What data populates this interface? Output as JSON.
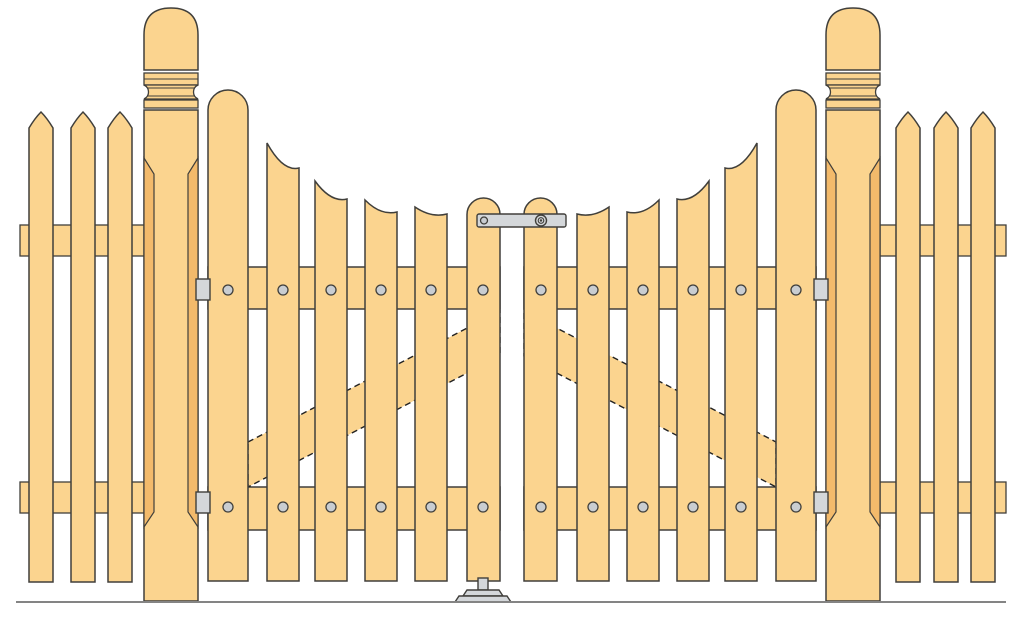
{
  "illustration": {
    "title": "Wooden double picket gate with turned posts and picket fence",
    "colors": {
      "wood": "#FBD48F",
      "wood_shade": "#F3BA6B",
      "outline": "#403F3B",
      "hardware": "#D4D7DA",
      "screw": "#C9CDD1",
      "ground": "#848484",
      "dash": "#222222"
    },
    "canvas": {
      "width": 1024,
      "height": 620
    },
    "ground_line": {
      "x1": 16,
      "y1": 602,
      "x2": 1006,
      "y2": 602
    },
    "fence": {
      "picket_width": 24,
      "picket_apex_y": 112,
      "picket_shoulder_y": 128,
      "picket_bottom_y": 582,
      "rail_upper_y": 225,
      "rail_lower_y": 482,
      "rail_height": 31,
      "left": {
        "rail_x1": 20,
        "rail_x2": 150,
        "pickets_x": [
          29,
          71,
          108
        ]
      },
      "right": {
        "rail_x1": 874,
        "rail_x2": 1006,
        "pickets_x": [
          896,
          934,
          971
        ]
      }
    },
    "posts": {
      "width": 54,
      "left_x": 144,
      "right_x": 826,
      "dome_top_y": 8,
      "dome_bottom_y": 70,
      "band1": [
        73,
        85
      ],
      "neck": [
        85,
        99
      ],
      "band2": [
        100,
        108
      ],
      "shaft": [
        110,
        601
      ],
      "chamfer": [
        158,
        527
      ],
      "chamfer_inset": 10
    },
    "gates": {
      "board_bottom_y": 581,
      "picket_width": 32,
      "rail_upper": {
        "y": 267,
        "h": 42
      },
      "rail_lower": {
        "y": 487,
        "h": 43
      },
      "screw_radius": 5,
      "screw_rows_y": [
        290,
        507
      ],
      "left": {
        "hanging_stile": {
          "x": 208,
          "w": 40,
          "cap_apex_y": 90
        },
        "center_stile": {
          "x": 467,
          "w": 33,
          "cap_apex_y": 198
        },
        "rail_x1": 208,
        "rail_x2": 500,
        "pickets": [
          {
            "x": 267,
            "y_outer": 143,
            "y_inner": 168
          },
          {
            "x": 315,
            "y_outer": 181,
            "y_inner": 199
          },
          {
            "x": 365,
            "y_outer": 200,
            "y_inner": 212
          },
          {
            "x": 415,
            "y_outer": 207,
            "y_inner": 214
          }
        ],
        "screws_x": [
          228,
          283,
          331,
          381,
          431,
          483
        ],
        "brace_points": "248,442 500,311 500,356 248,487"
      },
      "right": {
        "hanging_stile": {
          "x": 776,
          "w": 40,
          "cap_apex_y": 90
        },
        "center_stile": {
          "x": 524,
          "w": 33,
          "cap_apex_y": 198
        },
        "rail_x1": 524,
        "rail_x2": 816,
        "pickets": [
          {
            "x": 577,
            "y_outer": 207,
            "y_inner": 214,
            "mirror": true
          },
          {
            "x": 627,
            "y_outer": 200,
            "y_inner": 212,
            "mirror": true
          },
          {
            "x": 677,
            "y_outer": 181,
            "y_inner": 199,
            "mirror": true
          },
          {
            "x": 725,
            "y_outer": 143,
            "y_inner": 168,
            "mirror": true
          }
        ],
        "screws_x": [
          541,
          593,
          643,
          693,
          741,
          796
        ],
        "brace_points": "524,311 776,442 776,487 524,356"
      }
    },
    "hardware": {
      "hinges": [
        {
          "x": 196,
          "y": 279,
          "w": 14,
          "h": 21
        },
        {
          "x": 196,
          "y": 492,
          "w": 14,
          "h": 21
        },
        {
          "x": 814,
          "y": 279,
          "w": 14,
          "h": 21
        },
        {
          "x": 814,
          "y": 492,
          "w": 14,
          "h": 21
        }
      ],
      "latch": {
        "bar_x": 477,
        "bar_y": 214,
        "bar_w": 89,
        "bar_h": 13,
        "pivot_cx": 484,
        "pivot_cy": 220.5,
        "pivot_r": 3.5,
        "ring_cx": 541,
        "ring_cy": 220.5,
        "ring_r_outer": 5.5,
        "ring_r_inner": 2.8
      },
      "drop_bolt": {
        "rod_x": 478,
        "rod_y": 578,
        "rod_w": 10,
        "rod_h": 12,
        "tier1_points": "463,596 467,590 499,590 503,596",
        "tier2_points": "455,602 459,596 507,596 511,602"
      }
    }
  }
}
